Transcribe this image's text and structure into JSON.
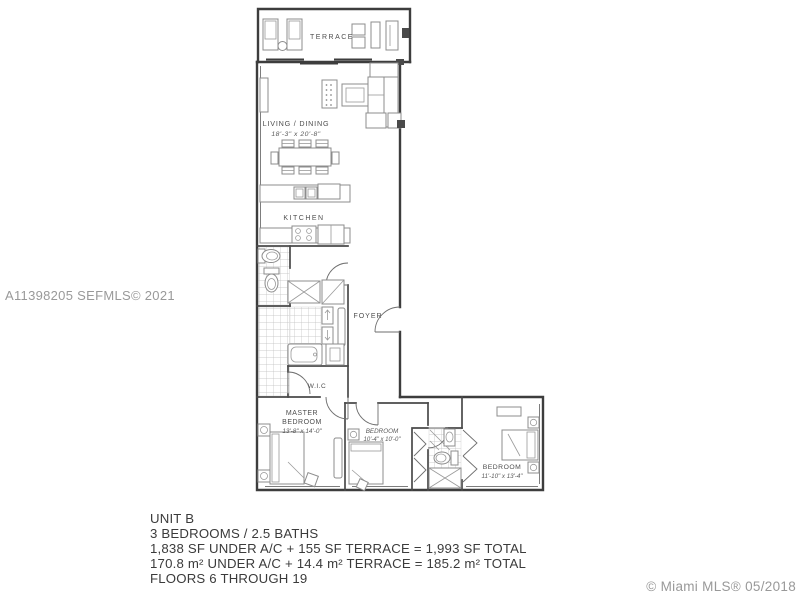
{
  "rooms": {
    "terrace": "TERRACE",
    "living": "LIVING / DINING",
    "living_dims": "18'-3\" x 20'-8\"",
    "kitchen": "KITCHEN",
    "foyer": "FOYER",
    "wic": "W.I.C",
    "master1": "MASTER",
    "master2": "BEDROOM",
    "master_dims": "13'-8\" x 14'-0\"",
    "bedroom2": "BEDROOM",
    "bedroom2_dims": "10'-4\" x 10'-0\"",
    "bedroom3": "BEDROOM",
    "bedroom3_dims": "11'-10\" x 13'-4\""
  },
  "summary": {
    "line1": "UNIT B",
    "line2": "3 BEDROOMS / 2.5 BATHS",
    "line3": "1,838 SF UNDER A/C + 155 SF TERRACE = 1,993 SF TOTAL",
    "line4": "170.8 m² UNDER A/C + 14.4 m² TERRACE = 185.2 m² TOTAL",
    "line5": "FLOORS 6 THROUGH 19"
  },
  "watermarks": {
    "listing": "A11398205 SEFMLS© 2021",
    "brand": "© Miami MLS® 05/2018"
  },
  "colors": {
    "wall": "#3d3d3d",
    "furniture": "#8c8c8c",
    "tile": "#bdbdbd",
    "label": "#4e4e4e",
    "watermark": "#8f8f8f",
    "summary_text": "#3b3b3b",
    "background": "#ffffff"
  }
}
